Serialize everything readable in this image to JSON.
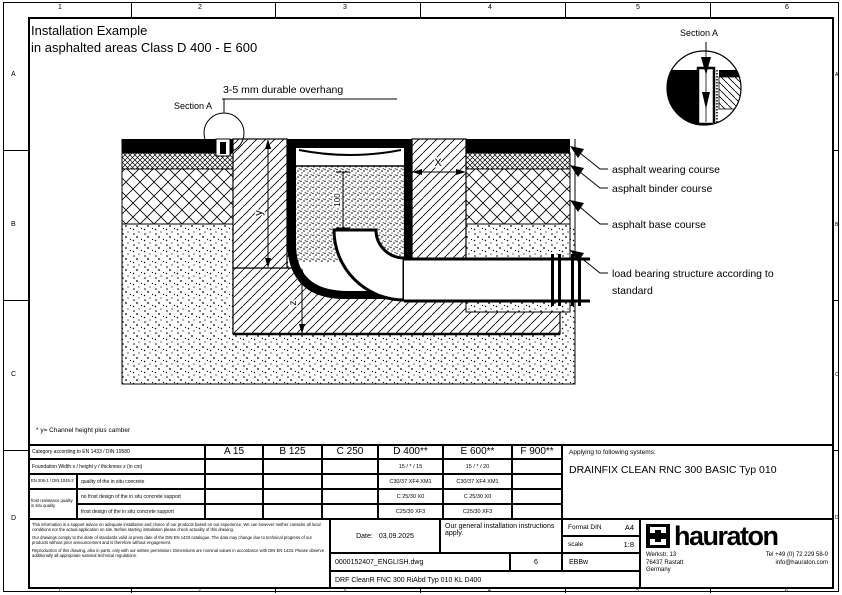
{
  "border": {
    "cols": [
      "1",
      "2",
      "3",
      "4",
      "5",
      "6"
    ],
    "rows": [
      "A",
      "B",
      "C",
      "D"
    ]
  },
  "drawing": {
    "title_line1": "Installation Example",
    "title_line2": "in asphalted areas Class D 400 - E 600",
    "section_label": "Section A",
    "detail_label": "Section A",
    "overhang_label": "3-5 mm durable overhang",
    "dim_x": "X",
    "dim_y": "y",
    "dim_z": "z",
    "dim_100": "100",
    "callout_wearing": "asphalt wearing course",
    "callout_binder": "asphalt binder course",
    "callout_base": "asphalt base course",
    "callout_load1": "load bearing structure according to",
    "callout_load2": "standard",
    "footnote": "* y= Channel height plus camber"
  },
  "table": {
    "category_label": "Category according to EN 1433 / DIN 19580",
    "col_headers": [
      "A 15",
      "B 125",
      "C 250",
      "D 400**",
      "E 600**",
      "F 900**"
    ],
    "foundation_label": "Foundation  Width x / height y / thickness z (in cm)",
    "foundation_d400": "15 / * / 15",
    "foundation_e600": "15 / * / 20",
    "concrete_group_top": "EN 206-1 / DIN 1045-2",
    "concrete_group_bottom": "frost resistance quality in situ quality",
    "rows": [
      {
        "label": "quality of the in situ concrete",
        "d400": "C30/37 XF4 XM1",
        "e600": "C30/37 XF4 XM1"
      },
      {
        "label": "no frost design of the in situ concrete support",
        "d400": "C 25/30 X0",
        "e600": "C 25/30 X0"
      },
      {
        "label": "frost design of the in situ concrete support",
        "d400": "C25/30 XF3",
        "e600": "C25/30 XF3"
      }
    ]
  },
  "systems": {
    "label": "Applying to following systems:",
    "value": "DRAINFIX CLEAN RNC 300 BASIC Typ 010"
  },
  "titleblock": {
    "date_label": "Date:",
    "date": "03.09.2025",
    "note": "Our general installation instructions apply.",
    "format_label": "Format DIN",
    "format_value": "A4",
    "scale_label": "scale",
    "scale_value": "1:8",
    "file_name": "0000152407_ENGLISH.dwg",
    "sheet": "6",
    "code": "EBBw",
    "drawing_code": "DRF CleanR FNC 300 RiAbd Typ 010 KL D400",
    "disclaimer": [
      "This information is a support advice on adequate installation and choice of our products based on our experience. We can however neither consider all local conditions nor the actual application on site. Before starting installation please check actuality of this drawing.",
      "Our drawings comply to the state of standards valid at press date of the DIN EN 1433 catalogue. The data may change due to technical progress of our products without prior announcement and is therefore without engagement.",
      "Reproduction of this drawing, also in parts, only with our written permission. Dimensions are nominal values in accordance with DIN EN 1433. Please observe additionally all appropriate national technical regulations."
    ]
  },
  "company": {
    "logo_text": "hauraton",
    "street": "Werkstr. 13",
    "city": "76437 Rastatt",
    "country": "Germany",
    "phone": "Tel +49 (0) 72 229 58-0",
    "email": "info@hauraton.com"
  },
  "colors": {
    "ink": "#000000",
    "paper": "#ffffff"
  }
}
